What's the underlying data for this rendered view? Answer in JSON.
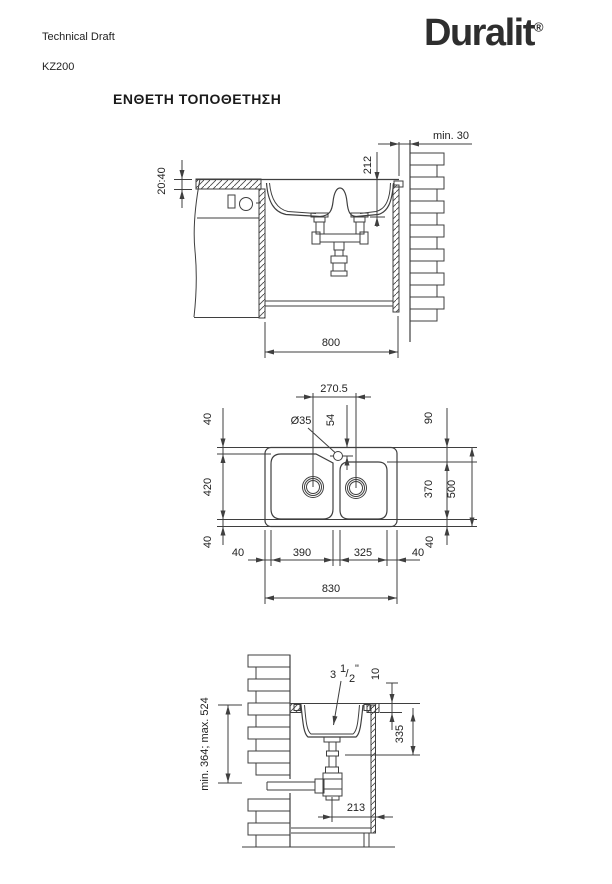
{
  "header": {
    "doc_type": "Technical Draft",
    "model": "KZ200",
    "brand": "Duralit",
    "trademark": "®",
    "title": "ΕΝΘΕΤΗ ΤΟΠΟΘΕΤΗΣΗ"
  },
  "colors": {
    "line": "#3f3f3f",
    "text": "#1f1f1f",
    "background": "#ffffff",
    "logo": "#2e2e2e"
  },
  "front_section": {
    "wall_clearance": "min. 30",
    "depth_to_drain": "212",
    "countertop_thickness": "20:40",
    "cabinet_width": "800"
  },
  "plan_view": {
    "drain_spacing": "270.5",
    "faucet_hole_diameter": "Ø35",
    "faucet_hole_offset": "54",
    "top_margin_left": "40",
    "top_margin_right": "90",
    "left_bowl_length": "420",
    "right_bowl_length": "370",
    "overall_depth": "500",
    "bottom_margin_left": "40",
    "bottom_margin_right": "40",
    "edge_margin_left": "40",
    "left_bowl_width": "390",
    "right_bowl_width": "325",
    "edge_margin_right": "40",
    "overall_width": "830"
  },
  "side_section": {
    "drain_size_whole": "3",
    "drain_size_numerator": "1",
    "drain_size_slash": "/",
    "drain_size_denominator": "2",
    "drain_size_unit": "\"",
    "rim_height": "10",
    "depth_to_trap": "335",
    "trap_height_range": "min. 364; max. 524",
    "drain_to_wall": "213"
  }
}
